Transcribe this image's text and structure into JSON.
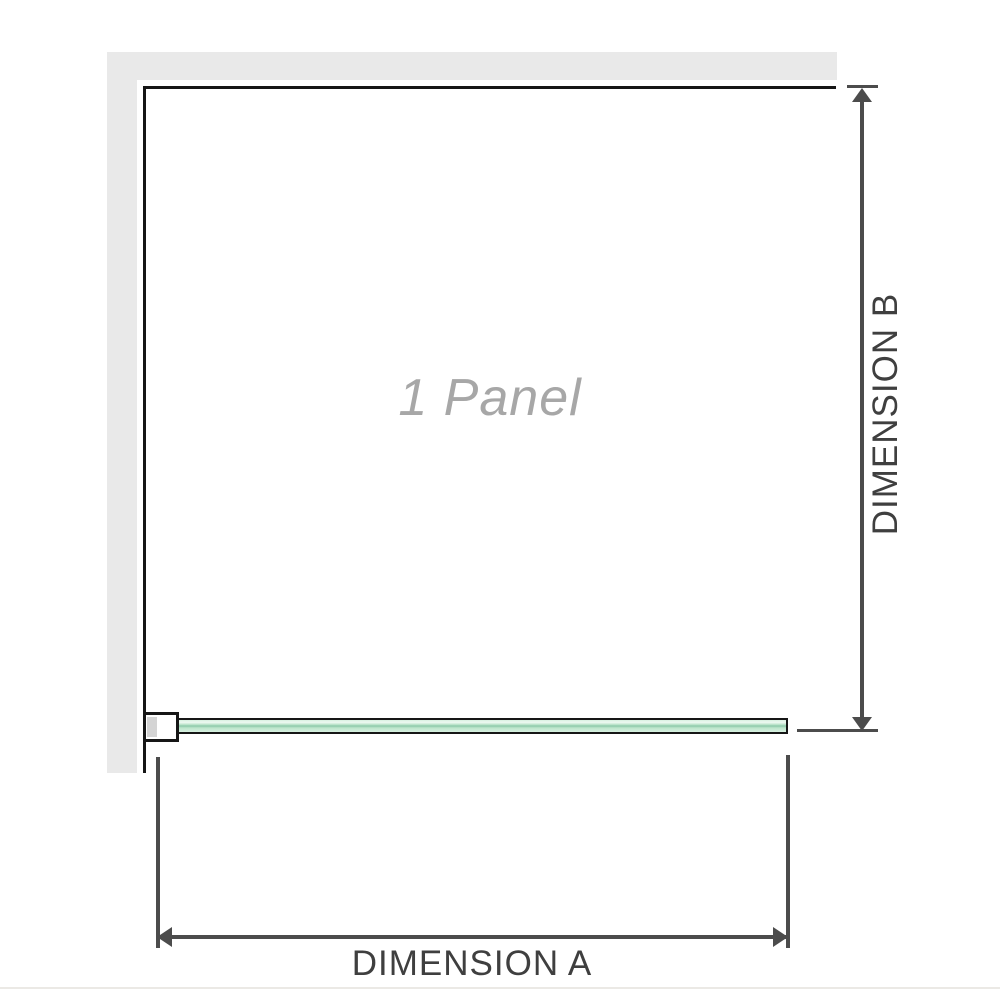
{
  "diagram": {
    "panel_label": "1 Panel",
    "dimension_a": {
      "label": "DIMENSION A"
    },
    "dimension_b": {
      "label": "DIMENSION B"
    }
  },
  "colors": {
    "background": "#ffffff",
    "wall_fill": "#e9e9e9",
    "edge_black": "#161616",
    "dim_line": "#4c4c4c",
    "dim_text": "#3f3f3f",
    "panel_text": "#a7a7a7",
    "bracket_pad": "#d4d4d4",
    "glass_light": "#d8f1e1",
    "glass_highlight": "#eef9f2",
    "glass_mid": "#bce5cb",
    "glass_dark": "#8cc9a9",
    "baseline": "#ebe9e5"
  }
}
